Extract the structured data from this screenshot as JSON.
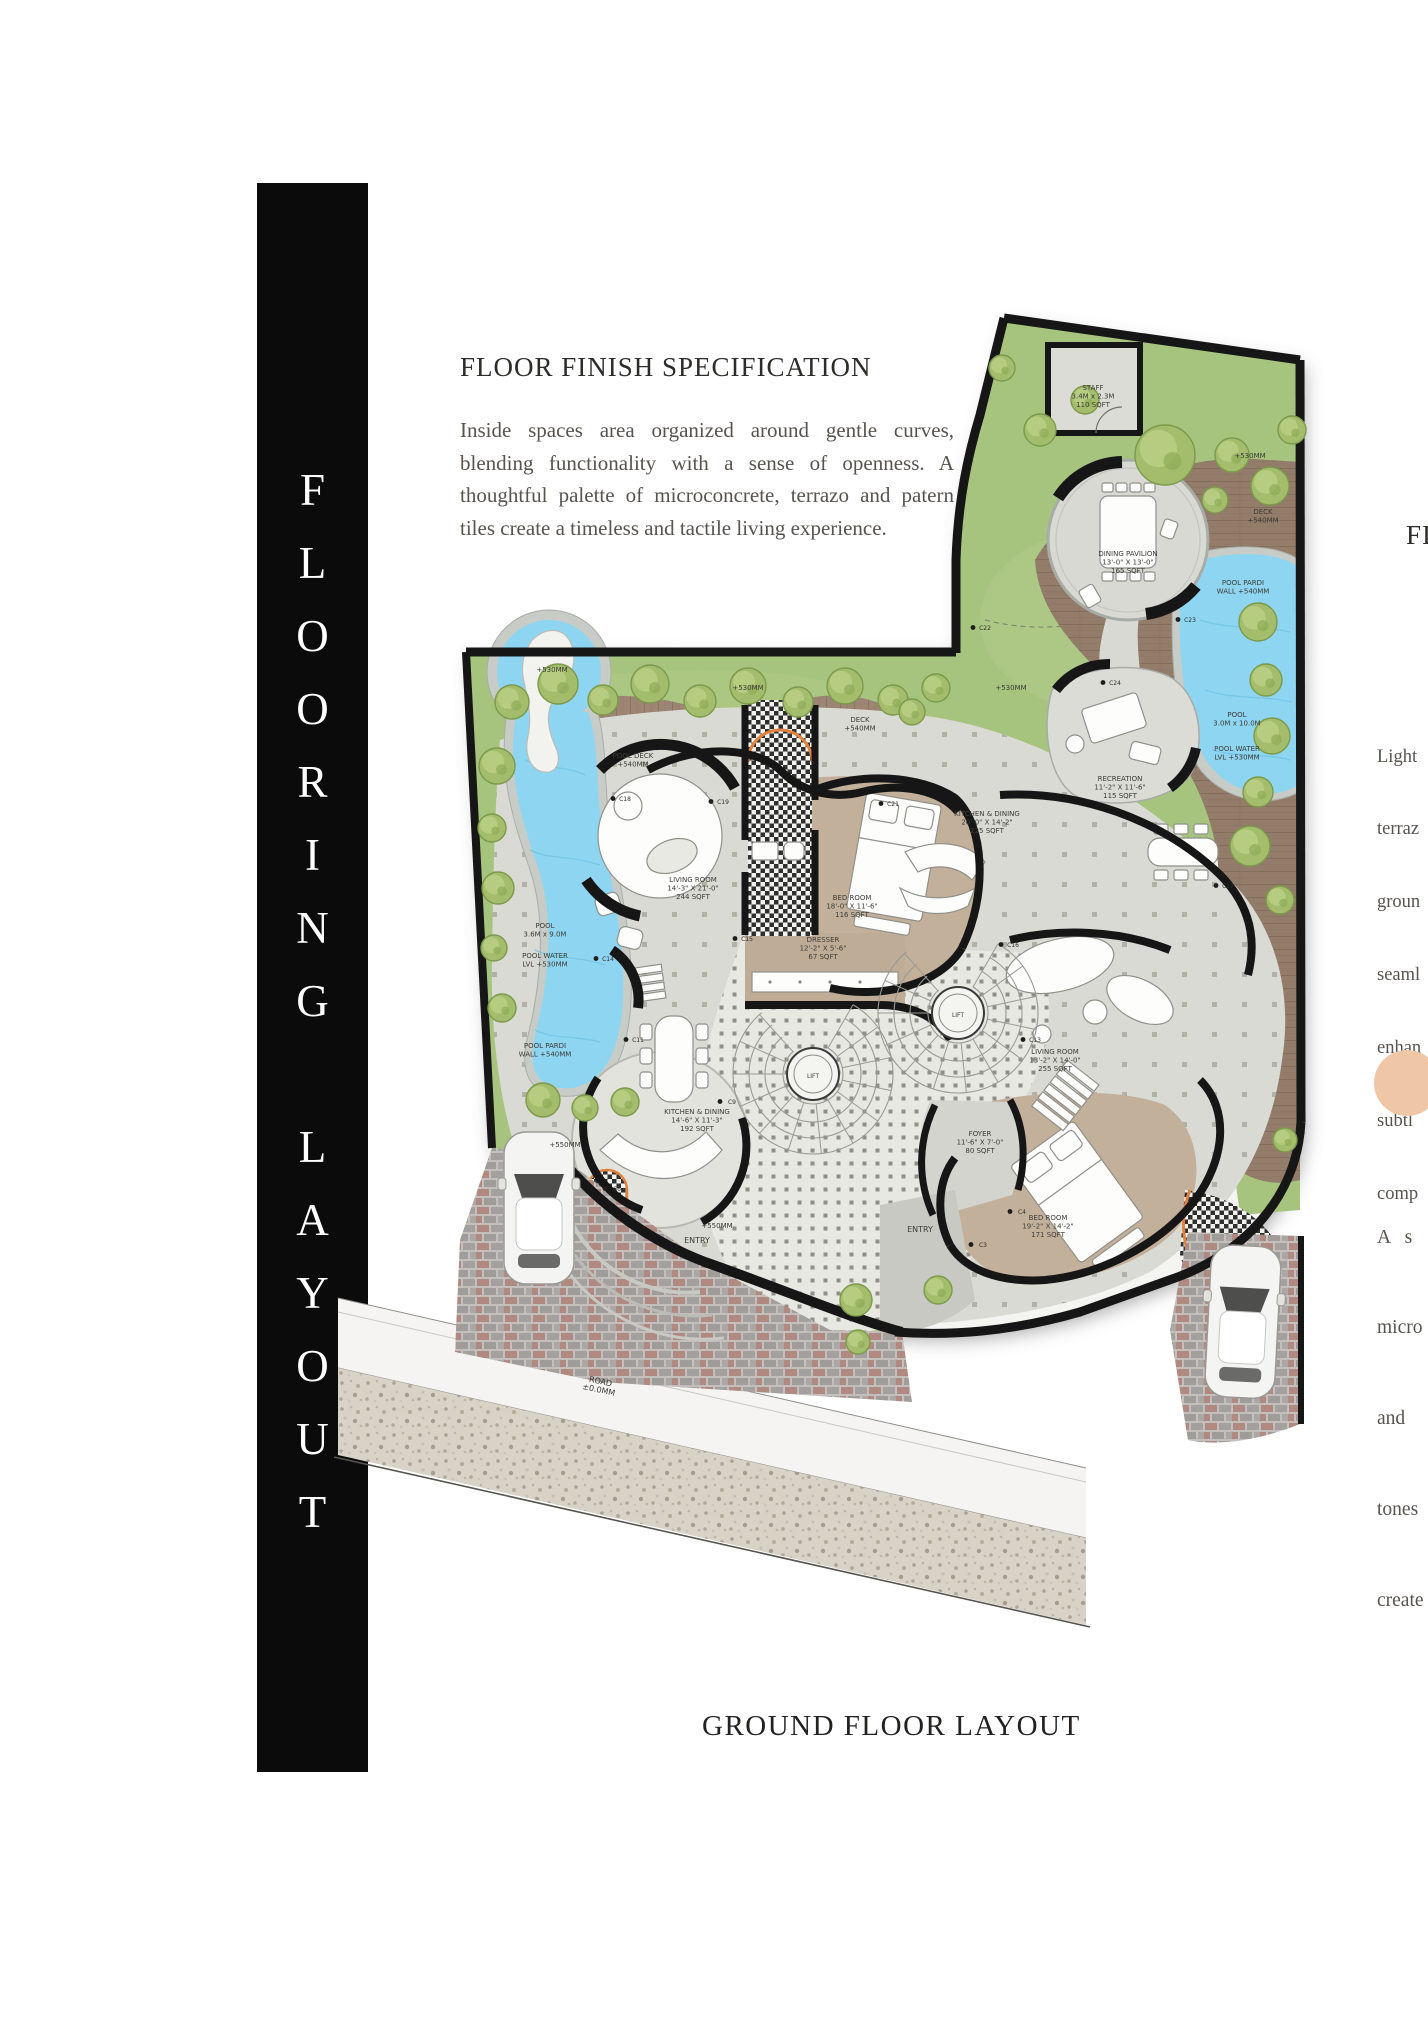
{
  "side_banner": "FLOORING LAYOUT",
  "header": {
    "title": "FLOOR FINISH SPECIFICATION",
    "paragraph": "Inside spaces area organized around gentle curves, blending functionality with a sense of openness. A thoughtful palette of microconcrete, terrazo and patern tiles create a timeless and tactile living experience."
  },
  "caption": "GROUND FLOOR LAYOUT",
  "right_column": {
    "heading_fragment": "FI",
    "para1_lines": [
      "Light",
      "terraz",
      "groun",
      "seaml",
      "enhan",
      "subtl",
      "comp"
    ],
    "para2_lines": [
      "A   s",
      "micro",
      "and",
      "tones",
      "create"
    ],
    "accent_circle_color": "#efc7a6"
  },
  "colors": {
    "banner_bg": "#0b0b0b",
    "grass": "#a7c47e",
    "deck": "#9c8573",
    "pool_water": "#8ed5f1",
    "floor": "#dadad4",
    "carpet": "#c3b09a",
    "wall": "#161616",
    "entry_arc_accent": "#e2823f"
  },
  "plan": {
    "labels": [
      {
        "x": 1093,
        "y": 390,
        "lines": [
          "STAFF",
          "3.4M x 2.3M",
          "110 SQFT"
        ]
      },
      {
        "x": 1128,
        "y": 556,
        "lines": [
          "DINING PAVILION",
          "13'-0\" X 13'-0\"",
          "165 SQFT"
        ]
      },
      {
        "x": 1263,
        "y": 514,
        "lines": [
          "DECK",
          "+540MM"
        ]
      },
      {
        "x": 1243,
        "y": 585,
        "lines": [
          "POOL PARDI",
          "WALL +540MM"
        ]
      },
      {
        "x": 1237,
        "y": 717,
        "lines": [
          "POOL",
          "3.0M x 10.0M"
        ]
      },
      {
        "x": 1237,
        "y": 751,
        "lines": [
          "POOL WATER",
          "LVL +530MM"
        ]
      },
      {
        "x": 1250,
        "y": 458,
        "lines": [
          "+530MM"
        ]
      },
      {
        "x": 748,
        "y": 690,
        "lines": [
          "+530MM"
        ]
      },
      {
        "x": 1011,
        "y": 690,
        "lines": [
          "+530MM"
        ]
      },
      {
        "x": 552,
        "y": 672,
        "lines": [
          "+530MM"
        ]
      },
      {
        "x": 860,
        "y": 722,
        "lines": [
          "DECK",
          "+540MM"
        ]
      },
      {
        "x": 633,
        "y": 758,
        "lines": [
          "POOL DECK",
          "+540MM"
        ]
      },
      {
        "x": 1120,
        "y": 781,
        "lines": [
          "RECREATION",
          "11'-2\" X 11'-6\"",
          "115 SQFT"
        ]
      },
      {
        "x": 987,
        "y": 816,
        "lines": [
          "KITCHEN & DINING",
          "20'-0\" X 14'-2\"",
          "225 SQFT"
        ]
      },
      {
        "x": 693,
        "y": 882,
        "lines": [
          "LIVING ROOM",
          "14'-3\" X 21'-0\"",
          "244 SQFT"
        ]
      },
      {
        "x": 852,
        "y": 900,
        "lines": [
          "BED ROOM",
          "18'-0\" X 11'-6\"",
          "116 SQFT"
        ]
      },
      {
        "x": 823,
        "y": 942,
        "lines": [
          "DRESSER",
          "12'-2\" X 5'-6\"",
          "67 SQFT"
        ]
      },
      {
        "x": 545,
        "y": 928,
        "lines": [
          "POOL",
          "3.6M x 9.0M"
        ]
      },
      {
        "x": 545,
        "y": 958,
        "lines": [
          "POOL WATER",
          "LVL +530MM"
        ]
      },
      {
        "x": 545,
        "y": 1048,
        "lines": [
          "POOL PARDI",
          "WALL +540MM"
        ]
      },
      {
        "x": 697,
        "y": 1114,
        "lines": [
          "KITCHEN & DINING",
          "14'-6\" X 11'-3\"",
          "192 SQFT"
        ]
      },
      {
        "x": 1055,
        "y": 1054,
        "lines": [
          "LIVING ROOM",
          "13'-2\" X 14'-0\"",
          "255 SQFT"
        ]
      },
      {
        "x": 980,
        "y": 1136,
        "lines": [
          "FOYER",
          "11'-6\" X 7'-0\"",
          "80 SQFT"
        ]
      },
      {
        "x": 1048,
        "y": 1220,
        "lines": [
          "BED ROOM",
          "19'-2\" X 14'-2\"",
          "171 SQFT"
        ]
      },
      {
        "x": 697,
        "y": 1243,
        "lines": [
          "ENTRY"
        ],
        "size": 8
      },
      {
        "x": 920,
        "y": 1232,
        "lines": [
          "ENTRY"
        ],
        "size": 8
      },
      {
        "x": 717,
        "y": 1228,
        "lines": [
          "+550MM"
        ]
      },
      {
        "x": 565,
        "y": 1147,
        "lines": [
          "+550MM"
        ]
      },
      {
        "x": 600,
        "y": 1384,
        "lines": [
          "ROAD",
          "±0.0MM"
        ],
        "size": 8,
        "rot": 12
      },
      {
        "x": 813,
        "y": 1078,
        "lines": [
          "LIFT"
        ],
        "size": 6
      },
      {
        "x": 958,
        "y": 1017,
        "lines": [
          "LIFT"
        ],
        "size": 6
      }
    ],
    "markers": [
      {
        "x": 1115,
        "y": 685,
        "t": "C24"
      },
      {
        "x": 1190,
        "y": 622,
        "t": "C23"
      },
      {
        "x": 985,
        "y": 630,
        "t": "C22"
      },
      {
        "x": 893,
        "y": 806,
        "t": "C21"
      },
      {
        "x": 723,
        "y": 804,
        "t": "C19"
      },
      {
        "x": 625,
        "y": 801,
        "t": "C18"
      },
      {
        "x": 1228,
        "y": 888,
        "t": "C17"
      },
      {
        "x": 747,
        "y": 941,
        "t": "C15"
      },
      {
        "x": 1013,
        "y": 947,
        "t": "C16"
      },
      {
        "x": 608,
        "y": 961,
        "t": "C14"
      },
      {
        "x": 638,
        "y": 1042,
        "t": "C11"
      },
      {
        "x": 732,
        "y": 1104,
        "t": "C9"
      },
      {
        "x": 1035,
        "y": 1042,
        "t": "C13"
      },
      {
        "x": 1022,
        "y": 1214,
        "t": "C4"
      },
      {
        "x": 983,
        "y": 1247,
        "t": "C3"
      },
      {
        "x": 617,
        "y": 1191,
        "t": "C6"
      }
    ],
    "trees": [
      [
        512,
        702,
        17
      ],
      [
        558,
        684,
        20
      ],
      [
        603,
        700,
        15
      ],
      [
        650,
        684,
        19
      ],
      [
        700,
        701,
        16
      ],
      [
        748,
        686,
        18
      ],
      [
        798,
        702,
        15
      ],
      [
        845,
        686,
        18
      ],
      [
        893,
        700,
        15
      ],
      [
        936,
        688,
        14
      ],
      [
        1002,
        368,
        13
      ],
      [
        1040,
        430,
        16
      ],
      [
        1085,
        400,
        14
      ],
      [
        1165,
        455,
        30
      ],
      [
        1232,
        455,
        17
      ],
      [
        1270,
        486,
        19
      ],
      [
        1292,
        430,
        14
      ],
      [
        1215,
        500,
        13
      ],
      [
        1258,
        622,
        19
      ],
      [
        1266,
        680,
        16
      ],
      [
        1272,
        736,
        18
      ],
      [
        1258,
        792,
        15
      ],
      [
        1250,
        846,
        20
      ],
      [
        1280,
        900,
        14
      ],
      [
        497,
        766,
        18
      ],
      [
        492,
        828,
        14
      ],
      [
        498,
        888,
        16
      ],
      [
        494,
        948,
        13
      ],
      [
        502,
        1008,
        14
      ],
      [
        543,
        1100,
        17
      ],
      [
        585,
        1108,
        13
      ],
      [
        625,
        1102,
        14
      ],
      [
        856,
        1300,
        16
      ],
      [
        858,
        1342,
        12
      ],
      [
        938,
        1290,
        14
      ],
      [
        1285,
        1140,
        12
      ],
      [
        912,
        712,
        13
      ]
    ],
    "stairs": [
      {
        "x": 813,
        "y": 1074
      },
      {
        "x": 958,
        "y": 1013
      }
    ],
    "cars": [
      {
        "x": 504,
        "y": 1132,
        "r": 0
      },
      {
        "x": 1212,
        "y": 1244,
        "r": 3
      }
    ]
  }
}
